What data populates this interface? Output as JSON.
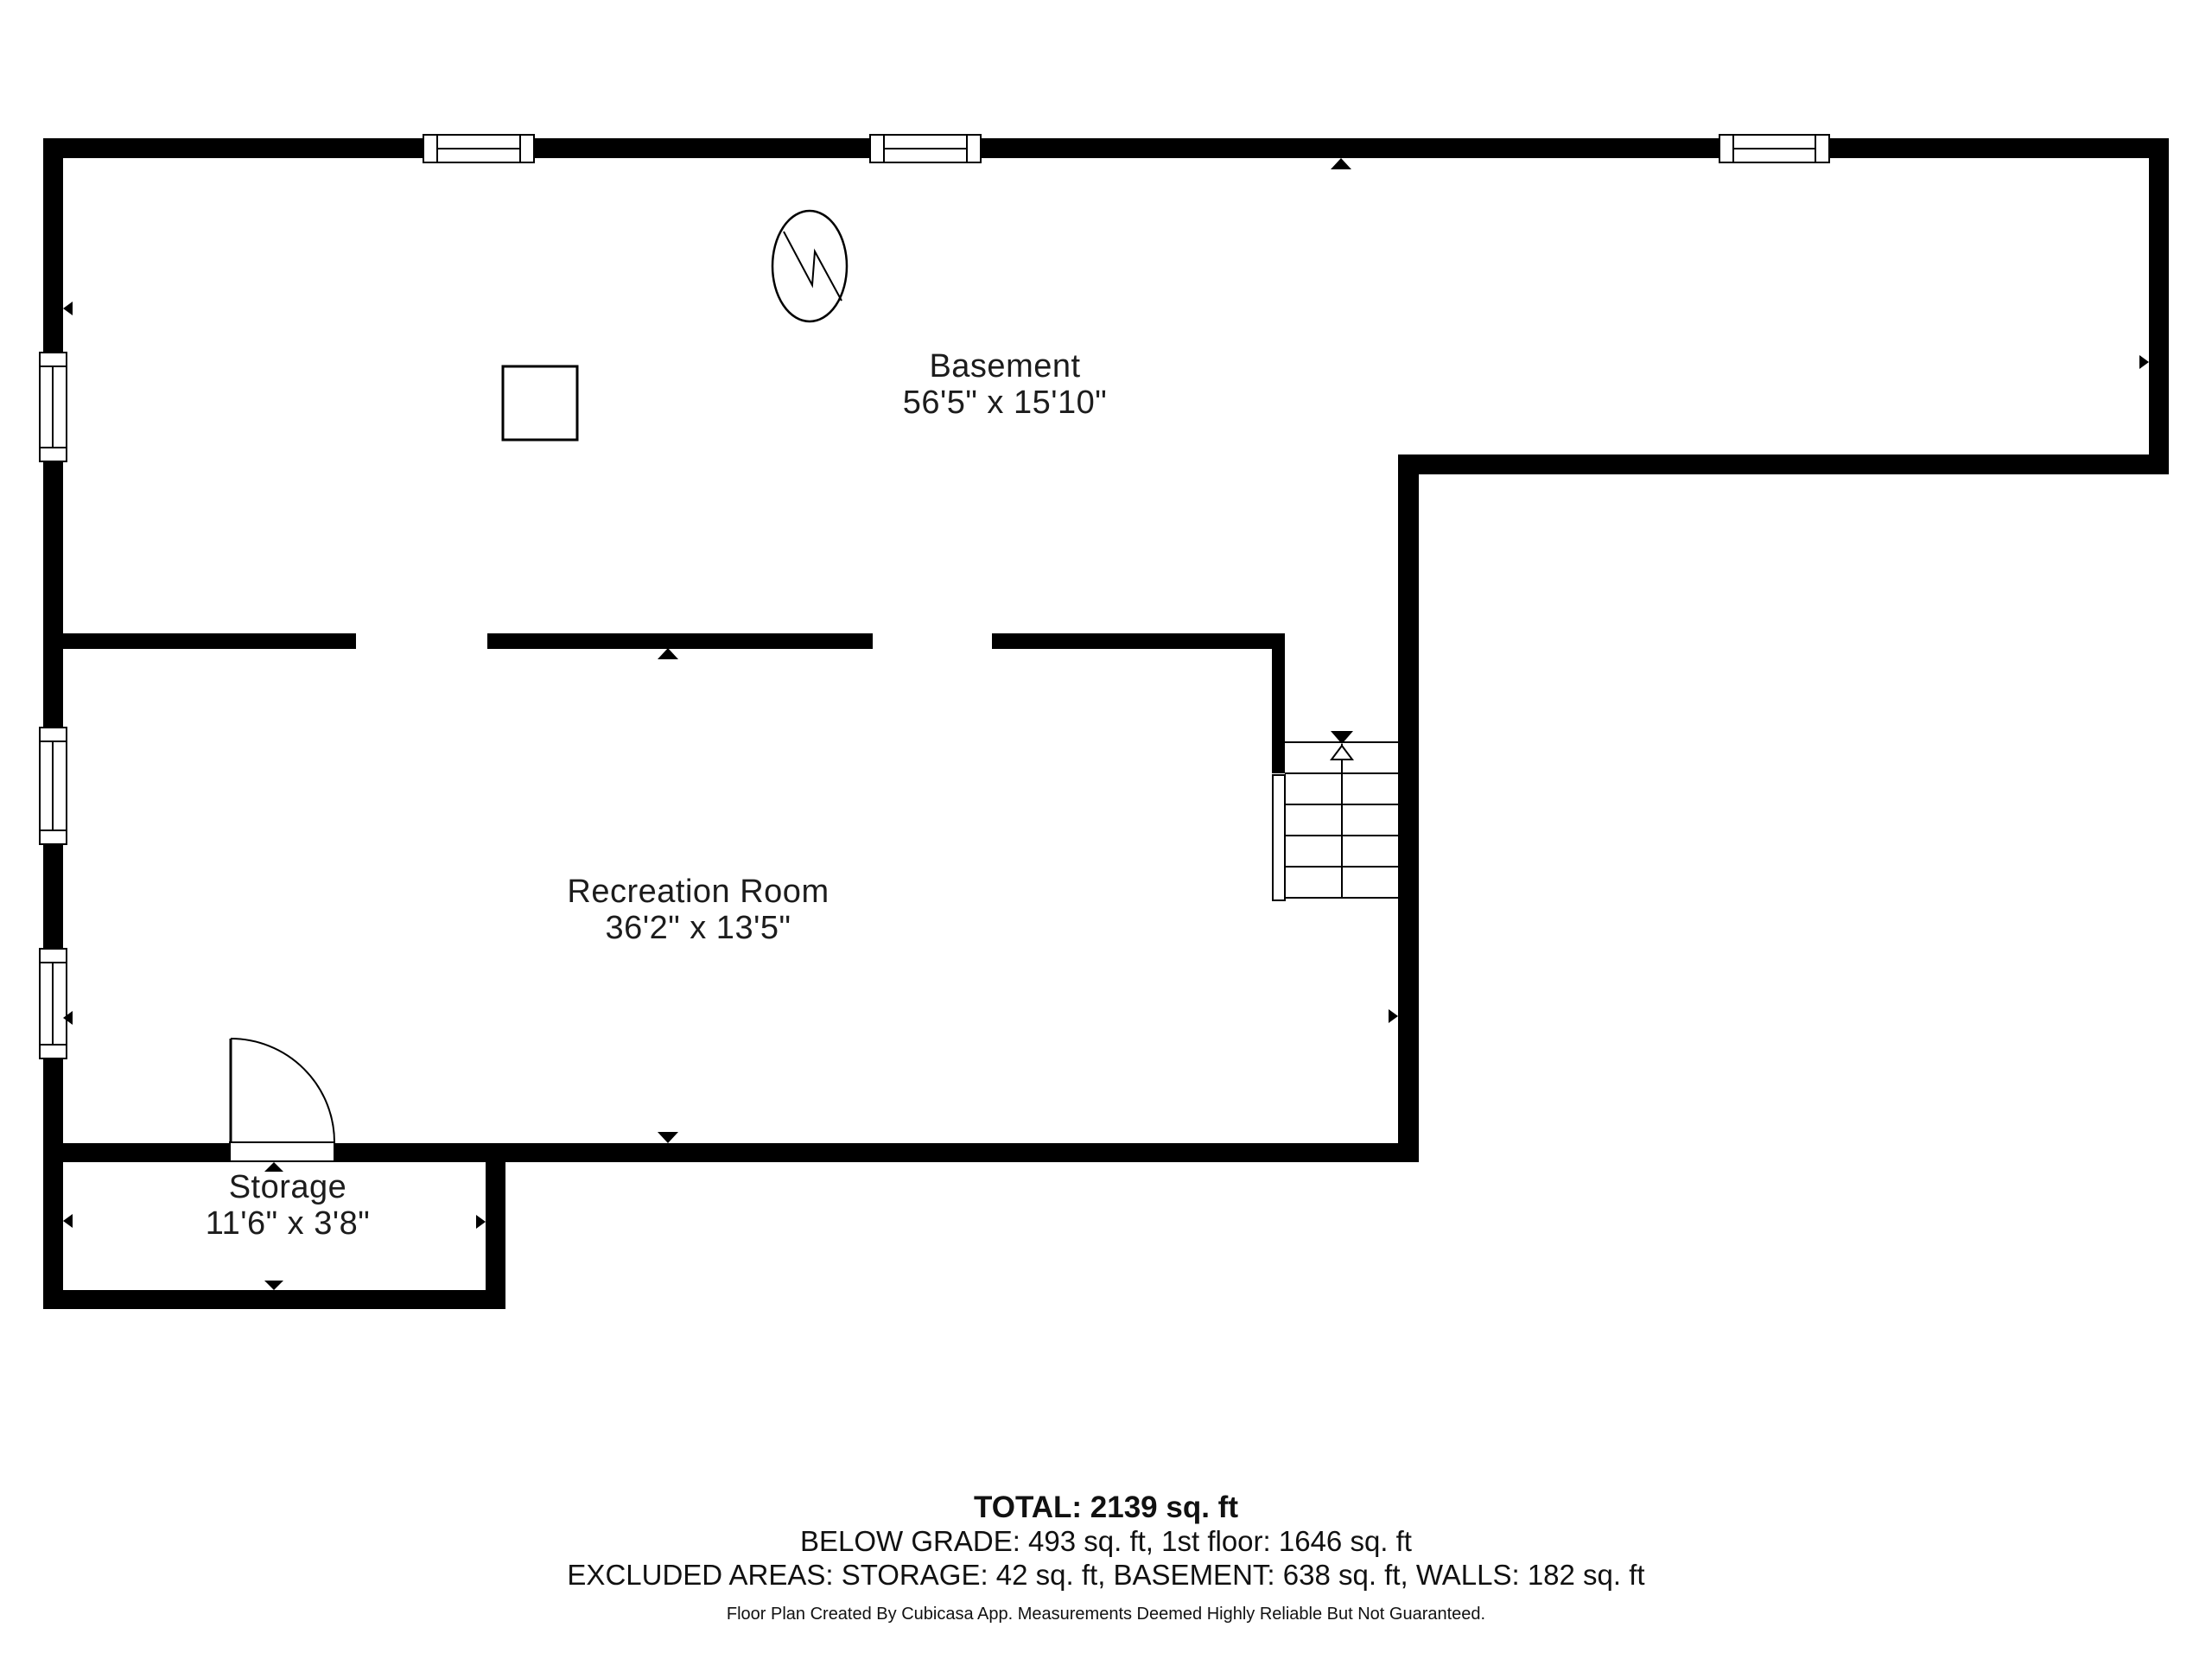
{
  "page": {
    "background": "#ffffff",
    "wall_color": "#000000",
    "text_color": "#1c1c1c"
  },
  "rooms": [
    {
      "name": "Basement",
      "dimensions": "56'5\" x 15'10\""
    },
    {
      "name": "Recreation Room",
      "dimensions": "36'2\" x 13'5\""
    },
    {
      "name": "Storage",
      "dimensions": "11'6\" x 3'8\""
    }
  ],
  "symbols": [
    {
      "name": "water-heater-icon"
    },
    {
      "name": "column-icon"
    },
    {
      "name": "staircase"
    },
    {
      "name": "door-swing"
    },
    {
      "name": "window"
    }
  ],
  "summary": {
    "total": "TOTAL: 2139 sq. ft",
    "below_grade": "BELOW GRADE: 493 sq. ft, 1st floor: 1646 sq. ft",
    "excluded": "EXCLUDED AREAS: STORAGE: 42 sq. ft, BASEMENT: 638 sq. ft, WALLS: 182 sq. ft",
    "disclaimer": "Floor Plan Created By Cubicasa App. Measurements Deemed Highly Reliable But Not Guaranteed."
  }
}
